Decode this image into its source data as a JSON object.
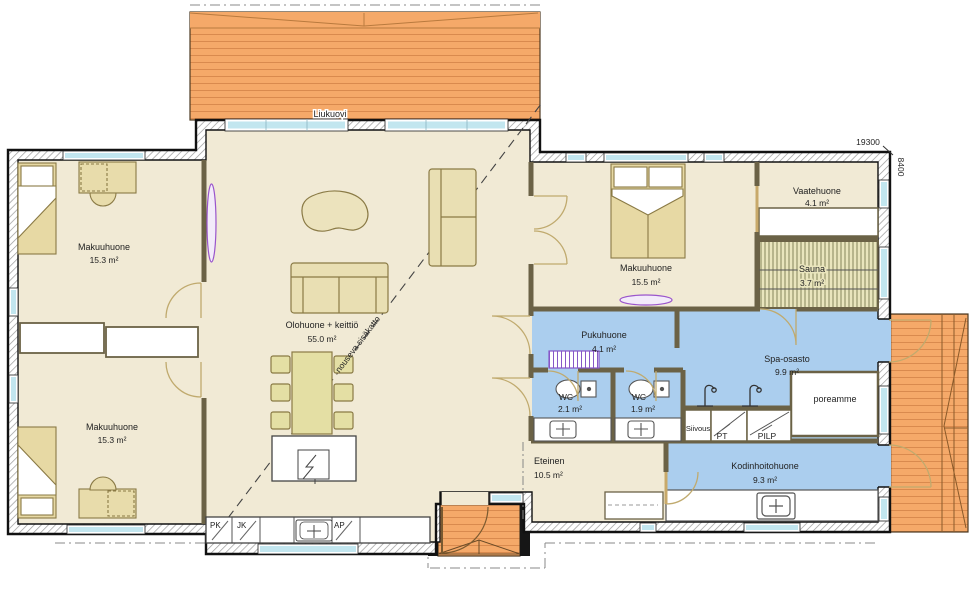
{
  "plan": {
    "dimensions": {
      "width_mm": "19300",
      "depth_mm": "8400"
    },
    "rooms": {
      "bedroom_top_left": {
        "name": "Makuuhuone",
        "area": "15.3 m²"
      },
      "bedroom_bottom_left": {
        "name": "Makuuhuone",
        "area": "15.3 m²"
      },
      "living_kitchen": {
        "name": "Olohuone + keittiö",
        "area": "55.0 m²"
      },
      "bedroom_right": {
        "name": "Makuuhuone",
        "area": "15.5 m²"
      },
      "walk_in_closet": {
        "name": "Vaatehuone",
        "area": "4.1 m²"
      },
      "sauna": {
        "name": "Sauna",
        "area": "3.7 m²"
      },
      "dressing_room": {
        "name": "Pukuhuone",
        "area": "4.1 m²"
      },
      "wc_left": {
        "name": "WC",
        "area": "2.1 m²"
      },
      "wc_right": {
        "name": "WC",
        "area": "1.9 m²"
      },
      "spa": {
        "name": "Spa-osasto",
        "area": "9.9 m²"
      },
      "utility_room": {
        "name": "Kodinhoitohuone",
        "area": "9.3 m²"
      },
      "entrance_hall": {
        "name": "Eteinen",
        "area": "10.5 m²"
      }
    },
    "features": {
      "sliding_door": "Liukuovi",
      "rising_ceiling": "nouseva sisäkatto",
      "whirlpool_tub": "poreamme",
      "cleaning_closet": "Siivous",
      "washing_tower": "PT",
      "heat_pump": "PILP",
      "freezer": "PK",
      "fridge": "JK",
      "dishwasher": "AP"
    },
    "colors": {
      "floor": "#f1ead5",
      "wet_room": "#abceee",
      "deck": "#f5a969",
      "furniture": "#e8dcab",
      "window_glass": "#c2e6ef",
      "exterior_wall": "#111111",
      "interior_wall": "#6b6246",
      "accent_purple": "#9a55cc"
    }
  }
}
